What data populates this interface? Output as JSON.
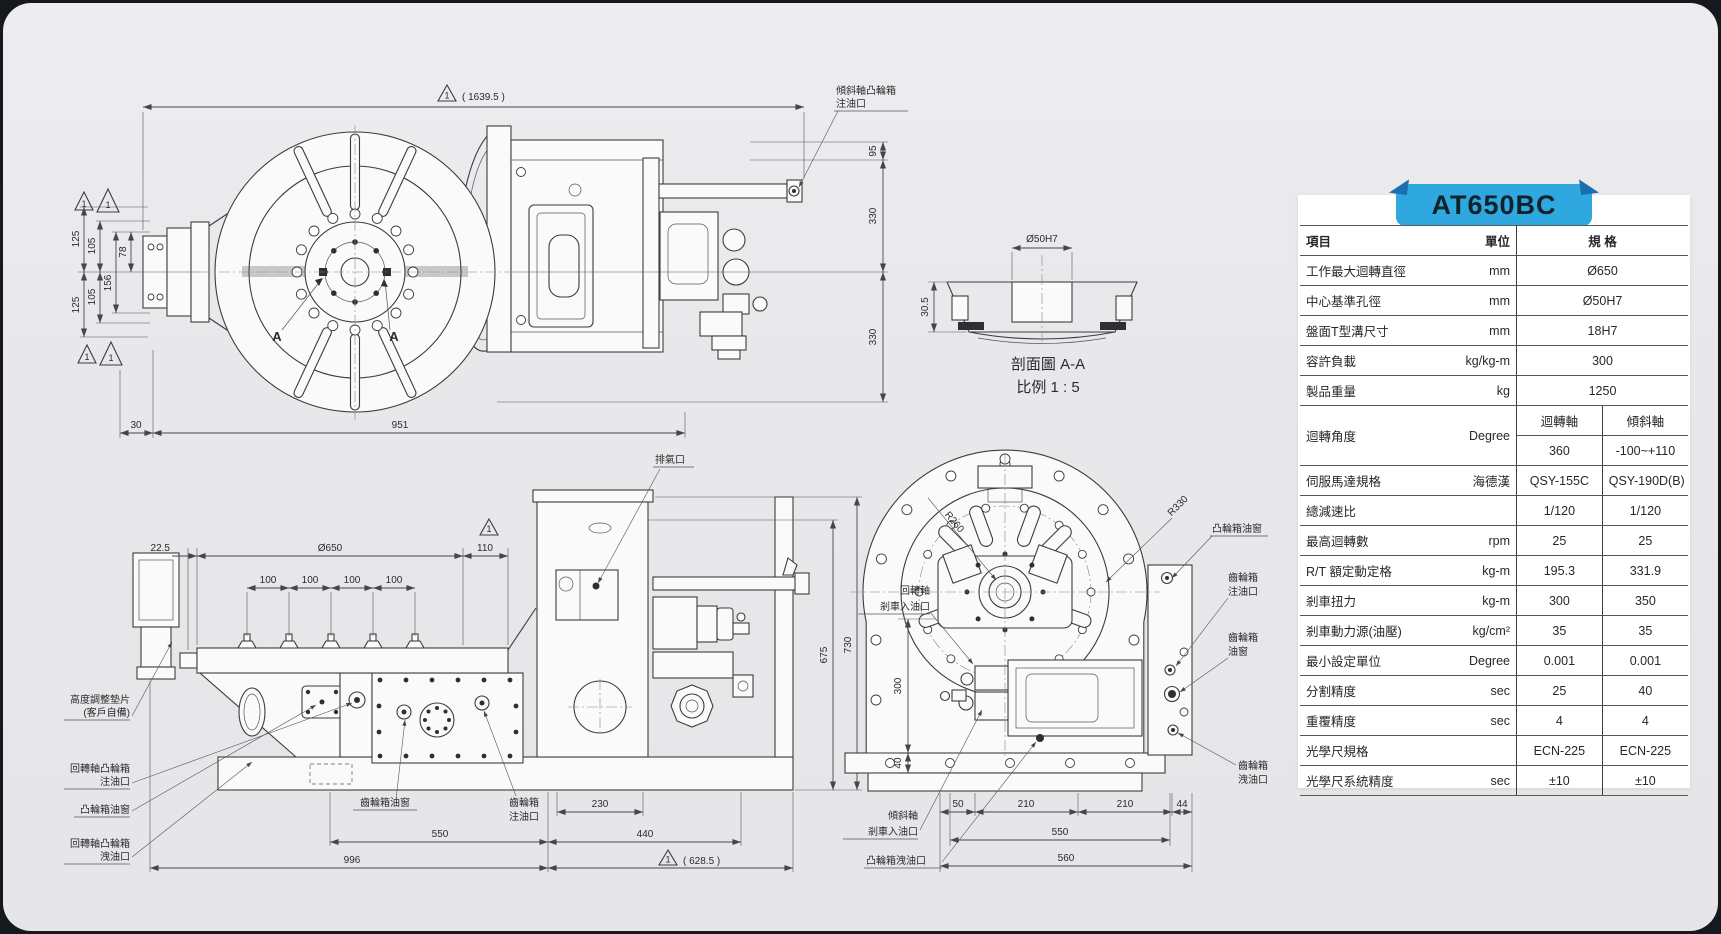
{
  "page": {
    "model": "AT650BC",
    "accent_blue": "#2fa8e0",
    "accent_blue_dark": "#1c6fae",
    "panel_gray": "#e9e9eb"
  },
  "front_view": {
    "flag": "1",
    "overall_dim": "( 1639.5 )",
    "tilt_cam_label_1": "傾斜軸凸輪箱",
    "tilt_cam_label_2": "注油口",
    "dim_95": "95",
    "dim_330a": "330",
    "dim_330b": "330",
    "dim_125a": "125",
    "dim_105a": "105",
    "dim_78": "78",
    "dim_156": "156",
    "dim_105b": "105",
    "dim_125b": "125",
    "datum_1": "1",
    "datum_2": "1",
    "datum_3": "1",
    "datum_4": "1",
    "section_a_left": "A",
    "section_a_right": "A",
    "dim_30": "30",
    "dim_951": "951"
  },
  "section_view": {
    "bore_dim": "Ø50H7",
    "depth_dim": "30.5",
    "title": "剖面圖 A-A",
    "scale": "比例 1 : 5"
  },
  "side_view": {
    "dim_22_5": "22.5",
    "dim_650": "Ø650",
    "dim_110": "110",
    "flag": "1",
    "dim_100_1": "100",
    "dim_100_2": "100",
    "dim_100_3": "100",
    "dim_100_4": "100",
    "exhaust_label": "排氣口",
    "dim_675": "675",
    "dim_730": "730",
    "shim_label_1": "高度調整墊片",
    "shim_label_2": "(客戶自備)",
    "rotary_cam_fill_1": "回轉軸凸輪箱",
    "rotary_cam_fill_2": "注油口",
    "cam_window_label": "凸輪箱油窗",
    "rotary_cam_drain_1": "回轉軸凸輪箱",
    "rotary_cam_drain_2": "洩油口",
    "gear_window_label": "齒輪箱油窗",
    "gear_fill_1": "齒輪箱",
    "gear_fill_2": "注油口",
    "dim_230": "230",
    "dim_550": "550",
    "dim_440": "440",
    "dim_996": "996",
    "flag2": "1",
    "dim_628": "( 628.5 )"
  },
  "rear_view": {
    "r260": "R260",
    "r330": "R330",
    "cam_window_label": "凸輪箱油窗",
    "gear_fill_1": "齒輪箱",
    "gear_fill_2": "注油口",
    "gear_window_1": "齒輪箱",
    "gear_window_2": "油窗",
    "gear_drain_1": "齒輪箱",
    "gear_drain_2": "洩油口",
    "rotary_brake_1": "回轉軸",
    "rotary_brake_2": "剎車入油口",
    "tilt_brake_1": "傾斜軸",
    "tilt_brake_2": "剎車入油口",
    "cam_drain_label": "凸輪箱洩油口",
    "dim_300": "300",
    "dim_40": "40",
    "dim_50": "50",
    "dim_210a": "210",
    "dim_210b": "210",
    "dim_44": "44",
    "dim_550": "550",
    "dim_560": "560"
  },
  "spec_table": {
    "model": "AT650BC",
    "header": {
      "item": "項目",
      "unit": "單位",
      "spec": "規 格"
    },
    "rows": [
      {
        "item": "工作最大迴轉直徑",
        "unit": "mm",
        "span": "Ø650"
      },
      {
        "item": "中心基準孔徑",
        "unit": "mm",
        "span": "Ø50H7"
      },
      {
        "item": "盤面T型溝尺寸",
        "unit": "mm",
        "span": "18H7"
      },
      {
        "item": "容許負載",
        "unit": "kg/kg-m",
        "span": "300"
      },
      {
        "item": "製品重量",
        "unit": "kg",
        "span": "1250"
      },
      {
        "item": "迴轉角度",
        "unit": "Degree",
        "sub_a": "迴轉軸",
        "sub_b": "傾斜軸",
        "a": "360",
        "b": "-100~+110"
      },
      {
        "item": "伺服馬達規格",
        "unit": "海德漢",
        "a": "QSY-155C",
        "b": "QSY-190D(B)"
      },
      {
        "item": "總減速比",
        "unit": "",
        "a": "1/120",
        "b": "1/120"
      },
      {
        "item": "最高迴轉數",
        "unit": "rpm",
        "a": "25",
        "b": "25"
      },
      {
        "item": "R/T 額定動定格",
        "unit": "kg-m",
        "a": "195.3",
        "b": "331.9"
      },
      {
        "item": "剎車扭力",
        "unit": "kg-m",
        "a": "300",
        "b": "350"
      },
      {
        "item": "剎車動力源(油壓)",
        "unit": "kg/cm²",
        "a": "35",
        "b": "35"
      },
      {
        "item": "最小設定單位",
        "unit": "Degree",
        "a": "0.001",
        "b": "0.001"
      },
      {
        "item": "分割精度",
        "unit": "sec",
        "a": "25",
        "b": "40"
      },
      {
        "item": "重覆精度",
        "unit": "sec",
        "a": "4",
        "b": "4"
      },
      {
        "item": "光學尺規格",
        "unit": "",
        "a": "ECN-225",
        "b": "ECN-225"
      },
      {
        "item": "光學尺系統精度",
        "unit": "sec",
        "a": "±10",
        "b": "±10"
      }
    ]
  }
}
